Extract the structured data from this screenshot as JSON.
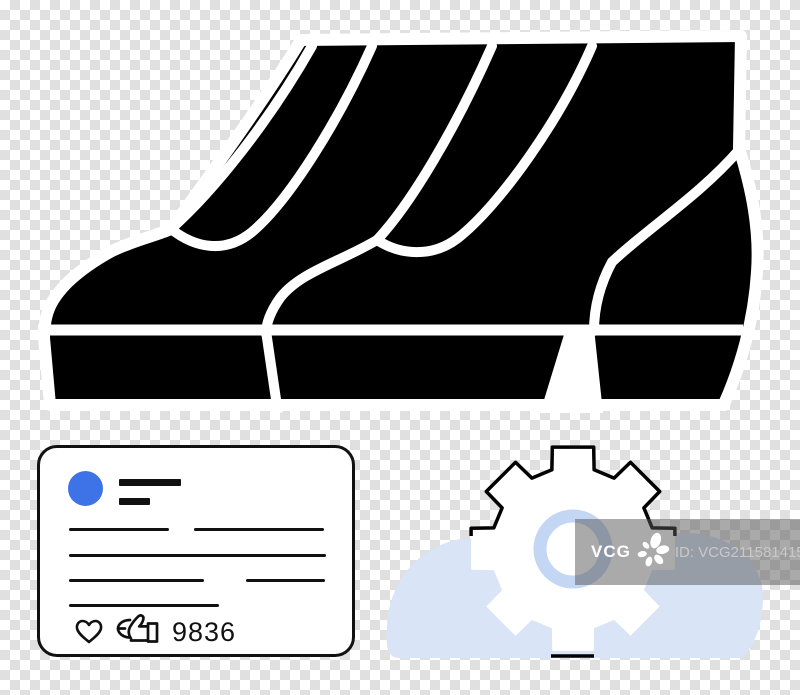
{
  "illustration": {
    "boots_icon": "boots-pair-icon",
    "cloud_gear_icon": "gear-cloud-icon"
  },
  "card": {
    "avatar_icon": "avatar-circle",
    "like_icons": [
      "heart-icon",
      "thumbs-up-icon"
    ],
    "like_count": "9836"
  },
  "watermark": {
    "brand": "VCG",
    "logo_icon": "vcg-flower-icon",
    "id_text": "ID: VCG211581415103"
  },
  "colors": {
    "checker_gray": "#e0e0e0",
    "boot_black": "#000000",
    "outline_white": "#ffffff",
    "avatar_blue": "#3e73e8",
    "cloud_blue": "#d9e4f6",
    "ring_blue": "#c3d6f3",
    "watermark_id_gray": "#c8c8c8"
  }
}
